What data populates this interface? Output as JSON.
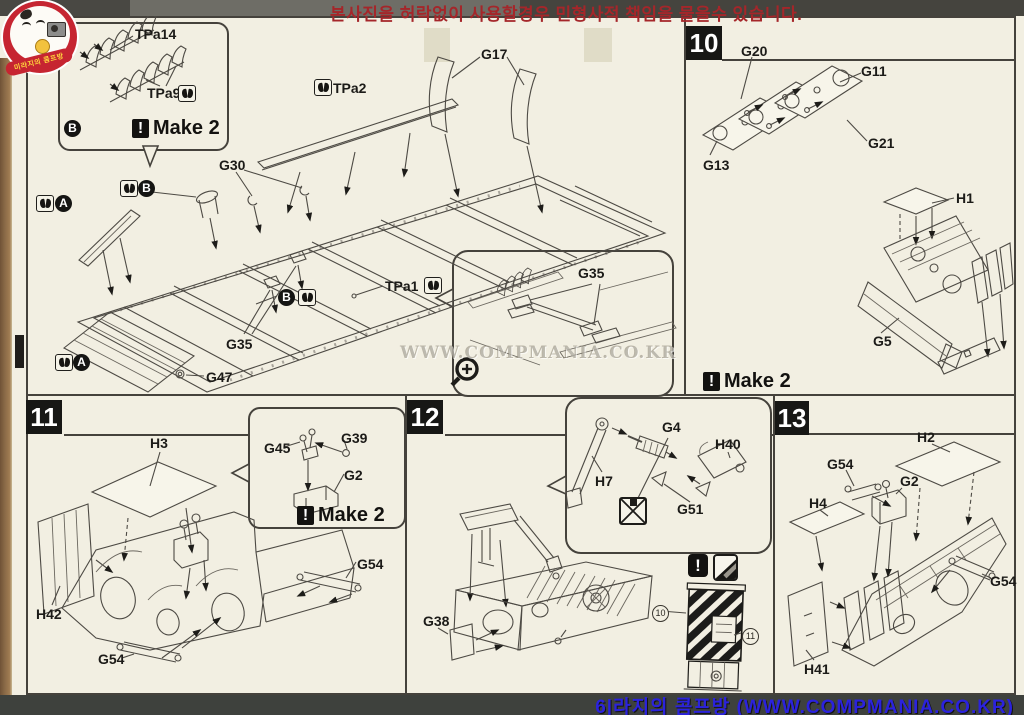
{
  "colors": {
    "accent_red": "#c62531",
    "step_box": "#171715",
    "banner_red": "#a5262a",
    "banner_blue": "#2b22dd",
    "paper": "#f2efe2"
  },
  "top_banner": {
    "text": "본사진을 허락없이 사용할경우 민형사적 책임을 물을수 있습니다."
  },
  "bottom_banner": {
    "text": "6|라지의 콤프방 (WWW.COMPMANIA.CO.KR)"
  },
  "watermark": {
    "text": "WWW.COMPMANIA.CO.KR"
  },
  "logo": {
    "ribbon_text": "미라지의 콤프방"
  },
  "steps": [
    {
      "number": "10"
    },
    {
      "number": "11"
    },
    {
      "number": "12"
    },
    {
      "number": "13"
    }
  ],
  "make2": {
    "icon": "!",
    "text": "Make 2"
  },
  "warning_icon": "!",
  "part_labels": [
    {
      "t": "TPa14",
      "x": 135,
      "y": 26
    },
    {
      "t": "TPa9",
      "x": 147,
      "y": 85
    },
    {
      "t": "TPa2",
      "x": 333,
      "y": 80
    },
    {
      "t": "G17",
      "x": 481,
      "y": 46
    },
    {
      "t": "G30",
      "x": 219,
      "y": 157
    },
    {
      "t": "G35",
      "x": 226,
      "y": 336
    },
    {
      "t": "G47",
      "x": 206,
      "y": 369
    },
    {
      "t": "TPa1",
      "x": 385,
      "y": 278
    },
    {
      "t": "G35",
      "x": 578,
      "y": 265
    },
    {
      "t": "G20",
      "x": 741,
      "y": 43
    },
    {
      "t": "G11",
      "x": 861,
      "y": 63
    },
    {
      "t": "G21",
      "x": 868,
      "y": 135
    },
    {
      "t": "G13",
      "x": 703,
      "y": 157
    },
    {
      "t": "H1",
      "x": 956,
      "y": 190
    },
    {
      "t": "G5",
      "x": 873,
      "y": 333
    },
    {
      "t": "H3",
      "x": 150,
      "y": 435
    },
    {
      "t": "G45",
      "x": 264,
      "y": 440
    },
    {
      "t": "G39",
      "x": 341,
      "y": 430
    },
    {
      "t": "G2",
      "x": 344,
      "y": 467
    },
    {
      "t": "G54",
      "x": 357,
      "y": 556
    },
    {
      "t": "H42",
      "x": 36,
      "y": 606
    },
    {
      "t": "G54",
      "x": 98,
      "y": 651
    },
    {
      "t": "G4",
      "x": 662,
      "y": 419
    },
    {
      "t": "H40",
      "x": 715,
      "y": 436
    },
    {
      "t": "H7",
      "x": 595,
      "y": 473
    },
    {
      "t": "G51",
      "x": 677,
      "y": 501
    },
    {
      "t": "G38",
      "x": 423,
      "y": 613
    },
    {
      "t": "H2",
      "x": 917,
      "y": 429
    },
    {
      "t": "G54",
      "x": 827,
      "y": 456
    },
    {
      "t": "G2",
      "x": 900,
      "y": 473
    },
    {
      "t": "H4",
      "x": 809,
      "y": 495
    },
    {
      "t": "G54",
      "x": 990,
      "y": 573
    },
    {
      "t": "H41",
      "x": 804,
      "y": 661
    }
  ],
  "cement_icon_positions": [
    {
      "x": 178,
      "y": 85
    },
    {
      "x": 314,
      "y": 79
    },
    {
      "x": 36,
      "y": 195
    },
    {
      "x": 120,
      "y": 180
    },
    {
      "x": 298,
      "y": 289
    },
    {
      "x": 55,
      "y": 354
    },
    {
      "x": 424,
      "y": 277
    }
  ],
  "markers": {
    "letters": [
      {
        "t": "B",
        "x": 64,
        "y": 120
      },
      {
        "t": "B",
        "x": 138,
        "y": 180
      },
      {
        "t": "A",
        "x": 55,
        "y": 195
      },
      {
        "t": "B",
        "x": 278,
        "y": 289
      },
      {
        "t": "A",
        "x": 73,
        "y": 354
      }
    ],
    "numbers": [
      {
        "t": "10",
        "x": 652,
        "y": 605
      },
      {
        "t": "11",
        "x": 742,
        "y": 628
      }
    ]
  }
}
